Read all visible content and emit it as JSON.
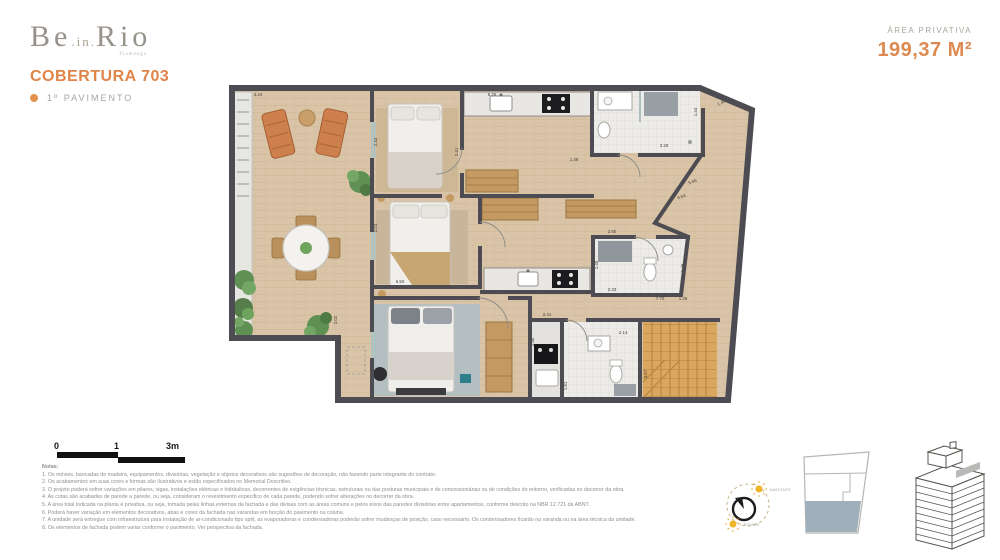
{
  "header": {
    "logo_be": "Be",
    "logo_in": ".in.",
    "logo_rio": "Rio",
    "logo_tagline": "Flamengo",
    "title": "COBERTURA 703",
    "subtitle": "1º PAVIMENTO",
    "area_label": "ÁREA PRIVATIVA",
    "area_value": "199,37 M²"
  },
  "scalebar": {
    "zero": "0",
    "one": "1",
    "three": "3m"
  },
  "compass": {
    "top_label": "NASCENTE",
    "bottom_label": "POENTE"
  },
  "colors": {
    "accent": "#E08448",
    "wall": "#4C4C52",
    "wood": "#D9C4A7",
    "unit_highlight": "#9FB0BA"
  },
  "plan": {
    "dimensions": [
      {
        "t": "3.24",
        "x": 258,
        "y": 96,
        "r": 0
      },
      {
        "t": "6.26",
        "x": 492,
        "y": 96,
        "r": 0
      },
      {
        "t": "1.44",
        "x": 697,
        "y": 112,
        "r": -90
      },
      {
        "t": "1.40",
        "x": 722,
        "y": 104,
        "r": -23
      },
      {
        "t": "3.28",
        "x": 664,
        "y": 147,
        "r": 0
      },
      {
        "t": "1.49",
        "x": 574,
        "y": 161,
        "r": 0
      },
      {
        "t": "5.56",
        "x": 693,
        "y": 183,
        "r": -20
      },
      {
        "t": "5.54",
        "x": 682,
        "y": 198,
        "r": -20
      },
      {
        "t": "2.43",
        "x": 377,
        "y": 142,
        "r": -90
      },
      {
        "t": "2.41",
        "x": 458,
        "y": 152,
        "r": -90
      },
      {
        "t": "2.03",
        "x": 377,
        "y": 228,
        "r": -90
      },
      {
        "t": "6.50",
        "x": 400,
        "y": 283,
        "r": 0
      },
      {
        "t": "2.02",
        "x": 337,
        "y": 320,
        "r": -90
      },
      {
        "t": "2.80",
        "x": 612,
        "y": 233,
        "r": 0
      },
      {
        "t": "1.40",
        "x": 598,
        "y": 265,
        "r": -90
      },
      {
        "t": "2.33",
        "x": 612,
        "y": 291,
        "r": 0
      },
      {
        "t": "1.45",
        "x": 684,
        "y": 268,
        "r": -90
      },
      {
        "t": "7.70",
        "x": 660,
        "y": 300,
        "r": 0
      },
      {
        "t": "1.26",
        "x": 683,
        "y": 300,
        "r": 0
      },
      {
        "t": "2.31",
        "x": 547,
        "y": 316,
        "r": 0
      },
      {
        "t": "2.40",
        "x": 534,
        "y": 342,
        "r": -90
      },
      {
        "t": "1.81",
        "x": 567,
        "y": 386,
        "r": -90
      },
      {
        "t": "2.14",
        "x": 623,
        "y": 334,
        "r": 0
      },
      {
        "t": "3.07",
        "x": 647,
        "y": 374,
        "r": -90
      }
    ]
  },
  "notes": {
    "title": "Notas:",
    "items": [
      "1. Os móveis, bancadas de madeira, equipamentos, divisórias, vegetação e objetos decorativos são sugestões de decoração, não fazendo parte integrante do contrato.",
      "2. Os acabamentos em suas cores e formas são ilustrativos e estão especificados no Memorial Descritivo.",
      "3. O projeto poderá sofrer variações em pilares, vigas, instalações elétricas e hidráulicas, decorrentes de exigências técnicas, estruturais ou das posturas municipais e de concessionárias ou de condições do entorno, verificadas no decorrer da obra.",
      "4. As cotas são acabadas de parede a parede, ou seja, consideram o revestimento específico de cada parede, podendo sofrer alterações no decorrer da obra.",
      "5. A área total indicada na planta é privativa, ou seja, tomada pelas linhas externas da fachada e das divisas com as áreas comuns e pelos eixos das paredes divisórias entre apartamentos, conforme descrito na NBR 12.721 da ABNT.",
      "6. Poderá haver variação em elementos decorativos, abas e cores da fachada nas varandas em função do pavimento ou coluna.",
      "7. A unidade será entregue com infraestrutura para instalação de ar-condicionado tipo split, as evaporadoras e condensadoras poderão sofrer mudanças de posição, caso necessário. Os condensadores ficarão na varanda ou na área técnica da unidade.",
      "8. Os elementos de fachada podem variar conforme o pavimento. Ver perspectiva da fachada."
    ]
  }
}
